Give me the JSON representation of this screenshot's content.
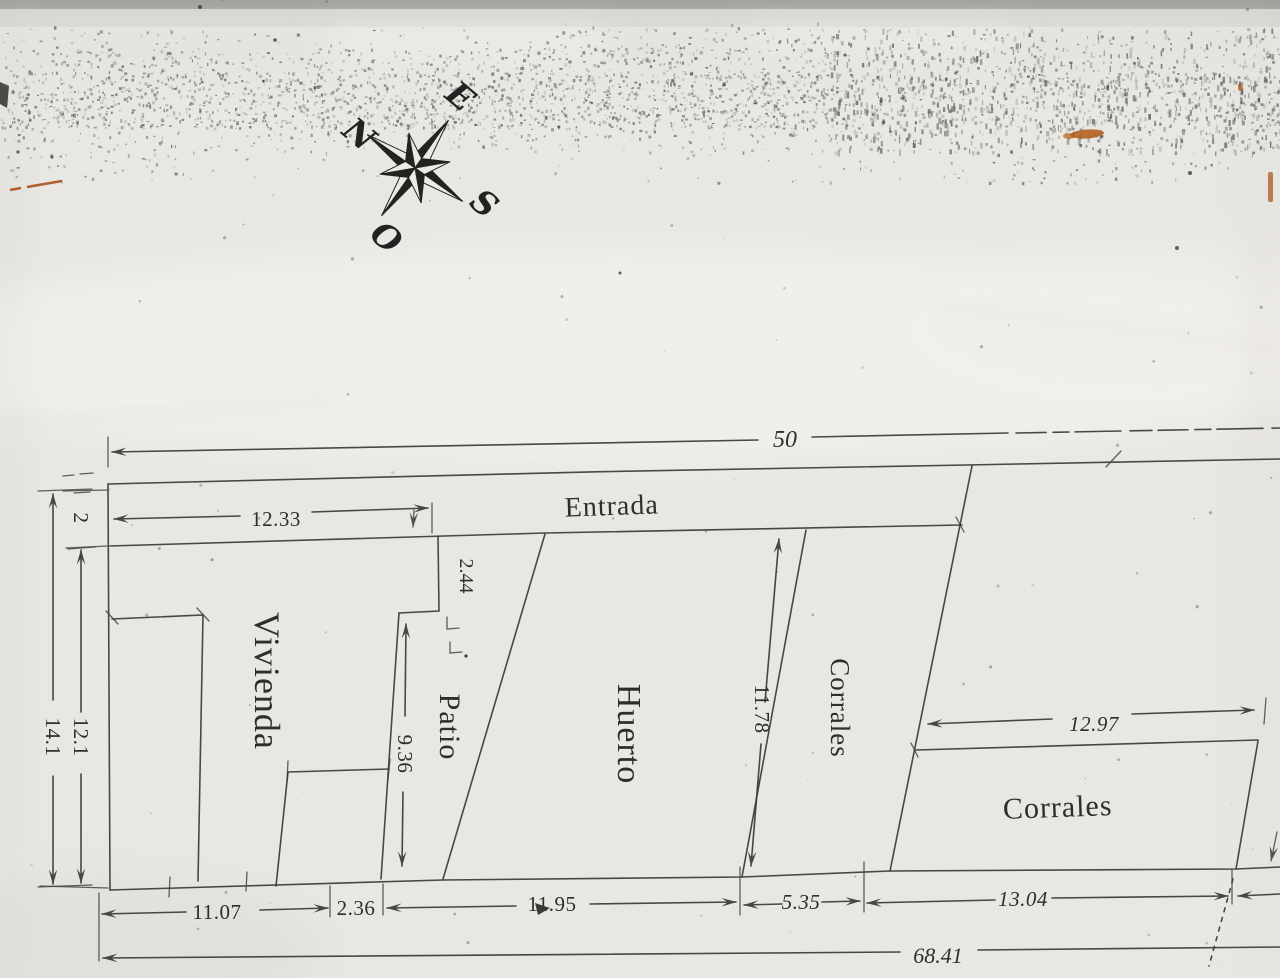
{
  "compass": {
    "north_label": "N",
    "east_label": "E",
    "south_label": "S",
    "west_label": "O"
  },
  "areas": {
    "entrada": "Entrada",
    "vivienda": "Vivienda",
    "patio": "Patio",
    "huerto": "Huerto",
    "corrales_strip": "Corrales",
    "corrales_lower": "Corrales"
  },
  "dimensions": {
    "top_width": "50",
    "entrada_width": "12.33",
    "step_depth": "2.44",
    "left_upper": "2",
    "left_outer": "14.1",
    "left_inner": "12.1",
    "patio_side": "9.36",
    "huerto_side": "11.78",
    "corrales_width": "12.97",
    "bottom_seg1": "11.07",
    "bottom_seg2": "2.36",
    "bottom_seg3": "11.95",
    "bottom_seg4": "5.35",
    "bottom_seg5": "13.04",
    "bottom_total": "68.41"
  }
}
